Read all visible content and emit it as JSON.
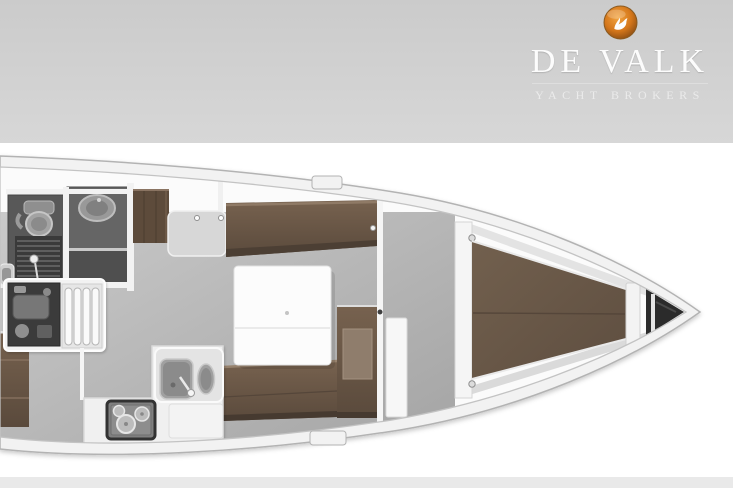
{
  "header": {
    "brand": "DE VALK",
    "tagline": "YACHT BROKERS",
    "logo": "falcon-badge"
  },
  "plan": {
    "type": "sailing-yacht-interior-layout-top-view",
    "regions": [
      "head-toilet",
      "shower-room",
      "engine-compartment",
      "companionway-steps",
      "aft-berth",
      "wardrobe",
      "chart-seat",
      "port-settee",
      "saloon-table",
      "galley-sink",
      "galley-stove",
      "starboard-settee",
      "nav-cabinet",
      "forward-cabin-door",
      "v-berth",
      "anchor-locker"
    ]
  },
  "colors": {
    "page_bg": "#ffffff",
    "header_top": "#cbcbcb",
    "header_bottom": "#d7d7d7",
    "footer_bg": "#e9e9e9",
    "brand_text": "#fcfcfc",
    "tagline_text": "#ebebeb",
    "rule": "#dedede",
    "badge_core": "#f2a440",
    "badge_mid": "#d4761a",
    "badge_rim": "#7d4512",
    "hull_stroke": "#b3b3b3",
    "hull_rim": "#f2f2f2",
    "interior": "#fbfbfb",
    "inner_line": "#c3c3c3",
    "floor_light": "#cacaca",
    "floor_dark": "#a3a3a3",
    "wood_light": "#8f7a66",
    "wood": "#6b5848",
    "wood_deep": "#4c3f34",
    "room_dark": "#585858",
    "room_floor": "#4f4f4f",
    "grate_dark": "#3a3a3a",
    "grate_line": "#757575",
    "locker": "#2b2b2b",
    "steel": "#a0a0a0",
    "steel_dark": "#8b8b8b",
    "furn_white": "#f2f2f2",
    "furn_stroke": "#d9d9d9"
  }
}
